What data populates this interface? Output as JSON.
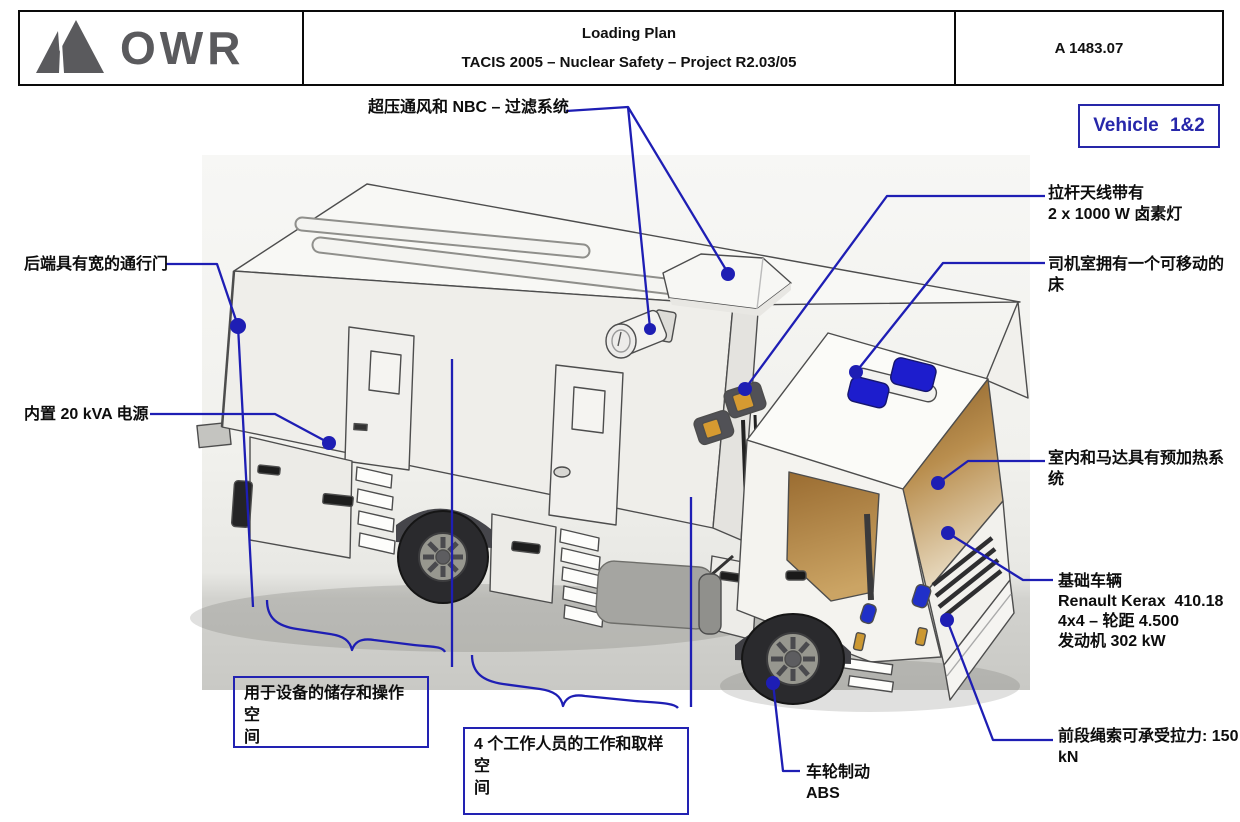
{
  "header": {
    "logo_text": "OWR",
    "title_line1": "Loading Plan",
    "title_line2": "TACIS 2005 – Nuclear Safety – Project R2.03/05",
    "doc_number": "A 1483.07"
  },
  "vehicle_badge": {
    "label": "Vehicle 1&2"
  },
  "callouts": {
    "nbc_filter": "超压通风和 NBC – 过滤系统",
    "antenna_lamps": "拉杆天线带有\n2 x 1000 W 卤素灯",
    "cab_bed": "司机室拥有一个可移动的\n床",
    "rear_door": "后端具有宽的通行门",
    "power_supply": "内置 20 kVA 电源",
    "preheating": "室内和马达具有预加热系\n统",
    "base_vehicle": "基础车辆\nRenault Kerax  410.18\n4x4 – 轮距 4.500\n发动机 302 kW",
    "front_rope": "前段绳索可承受拉力: 150\nkN",
    "wheel_brake": "车轮制动\nABS",
    "storage_space": "用于设备的储存和操作空\n间",
    "work_space": "4 个工作人员的工作和取样空\n间"
  },
  "colors": {
    "annotation_blue": "#1e1eb4",
    "badge_blue": "#2626a8"
  }
}
